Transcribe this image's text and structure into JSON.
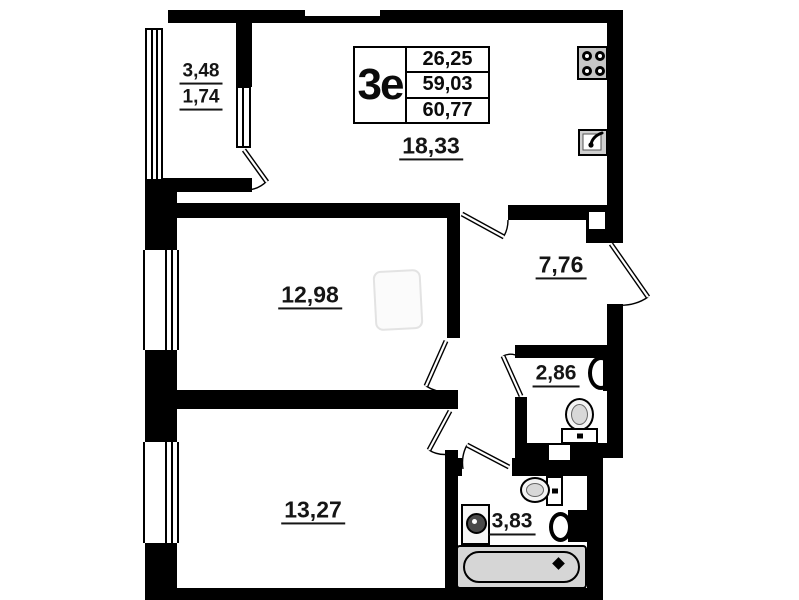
{
  "unit": {
    "type_label": "3е",
    "info_rows": [
      "26,25",
      "59,03",
      "60,77"
    ]
  },
  "rooms": {
    "balcony": {
      "area_total": "3,48",
      "area_counted": "1,74"
    },
    "kitchen_living": {
      "area": "18,33"
    },
    "bedroom_1": {
      "area": "12,98"
    },
    "hallway": {
      "area": "7,76"
    },
    "wc": {
      "area": "2,86"
    },
    "bedroom_2": {
      "area": "13,27"
    },
    "bathroom": {
      "area": "3,83"
    }
  },
  "colors": {
    "walls": "#000000",
    "fixtures_gray": "#c6c6c6",
    "bathtub_gray": "#d6d6d6",
    "background": "#ffffff"
  }
}
